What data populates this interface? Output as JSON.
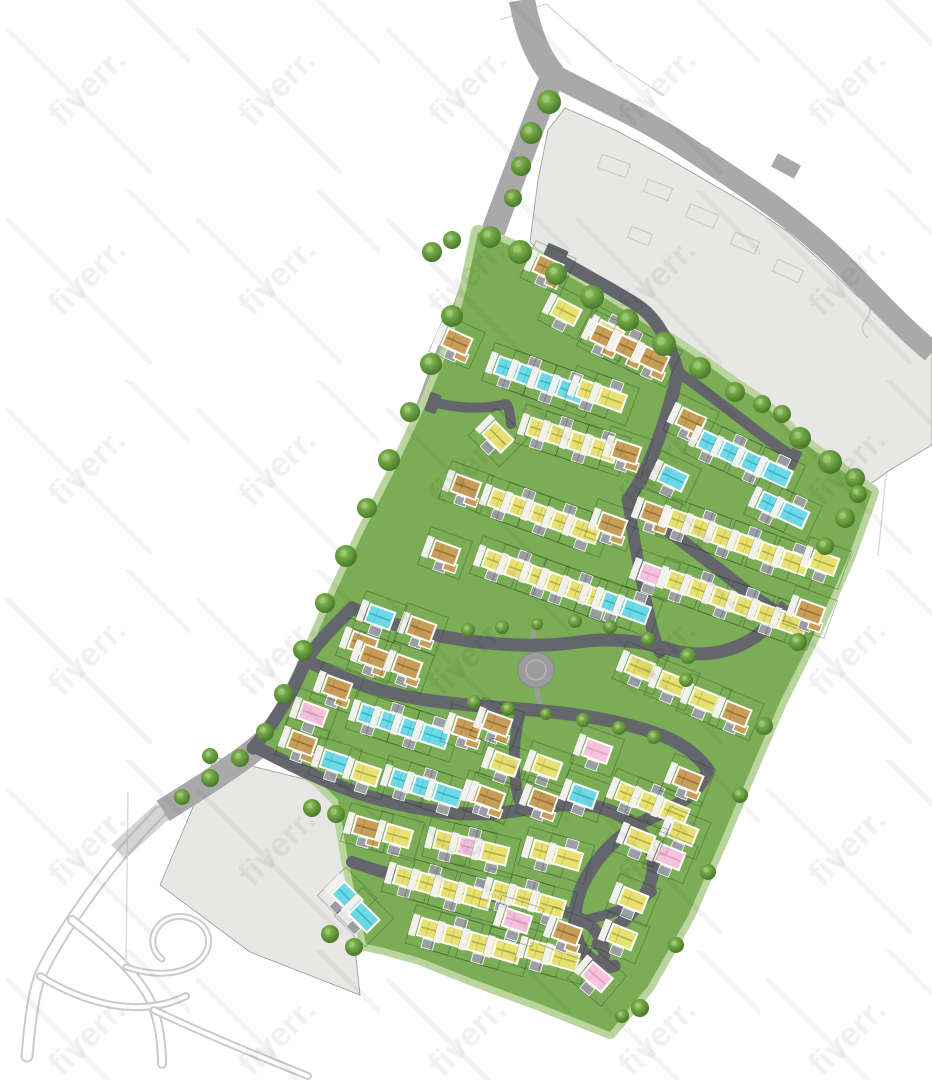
{
  "canvas": {
    "w": 932,
    "h": 1080
  },
  "watermark": {
    "text": "fiverr.",
    "tile": 190,
    "font_size": 34,
    "text_opacity": 0.055,
    "streak_opacity": 0.045
  },
  "colors": {
    "bg": "#ffffff",
    "road_outer": "#a9a9a9",
    "road_inner": "#64666c",
    "parcel": "#e7e7e5",
    "parcel_edge": "#9a9a98",
    "site_green": "#7aad55",
    "verge_green": "#b9d49c",
    "plaza": "#9c9c9e",
    "plot_line": "rgba(25,55,18,0.30)",
    "path_white": "#f2f1ed",
    "driveway": "#9b9ea2",
    "sketch": "#cbcbcb",
    "faint": "#d9d9d9",
    "roof": {
      "y": "#e6e170",
      "c": "#6ed9e6",
      "p": "#f6c3de",
      "t": "#c79d58"
    },
    "ridge": {
      "y": "#b6ad47",
      "c": "#38b6c9",
      "p": "#dd9ec4",
      "t": "#99743a"
    }
  },
  "site": {
    "points": "478,232 540,258 600,295 655,330 700,360 735,385 762,403 800,440 855,480 872,492 848,558 816,630 780,702 754,762 722,838 688,916 648,986 610,1032 540,1004 470,978 420,958 384,948 366,944 348,860 338,800 318,780 290,762 262,744 282,712 305,662 332,600 362,535 395,470 428,400 452,340 466,290"
  },
  "parcels": {
    "north": {
      "points": "565,108 615,130 662,155 705,180 748,205 788,232 822,262 856,295 890,322 932,352 932,445 890,470 862,490 830,465 790,435 755,405 725,382 690,358 650,328 600,292 548,260 530,242 538,180 548,130"
    },
    "sw": {
      "points": "215,757 320,783 338,802 350,900 360,995 250,952 160,885 196,800"
    }
  },
  "parcel_outlines": [
    [
      614,
      166,
      30,
      14,
      20
    ],
    [
      658,
      190,
      26,
      13,
      21
    ],
    [
      702,
      216,
      30,
      14,
      22
    ],
    [
      745,
      243,
      26,
      13,
      23
    ],
    [
      788,
      271,
      28,
      13,
      25
    ],
    [
      640,
      236,
      22,
      12,
      21
    ],
    [
      700,
      150,
      18,
      10,
      22
    ]
  ],
  "parcel_squiggles": [
    "M866,300 q8,10 0,20 q-8,10 2,18",
    "M688,142 q10,6 4,14"
  ],
  "boundary_roads": [
    {
      "d": "M522,0 C527,28 536,55 553,75",
      "w": 26,
      "op": 1
    },
    {
      "d": "M553,75 C600,100 640,116 688,148 C740,183 788,212 840,262 C872,295 905,330 932,352",
      "w": 22,
      "op": 1
    },
    {
      "d": "M553,75 C516,168 472,288 433,394 C396,496 346,610 301,694 C284,722 269,739 254,750 C226,772 196,790 163,811",
      "w": 24,
      "op": 1
    },
    {
      "d": "M163,811 L118,852",
      "w": 20,
      "op": 0.5
    }
  ],
  "road_stub": [
    786,
    166,
    26,
    15,
    28
  ],
  "road_notch": [
    173,
    777,
    26,
    16,
    -35
  ],
  "internal_roads": [
    {
      "d": "M556,258 C588,277 618,292 640,307 C658,320 670,344 678,372",
      "w": 13
    },
    {
      "d": "M678,372 C708,393 738,417 766,438 C778,447 786,452 792,457",
      "w": 11
    },
    {
      "d": "M678,372 C671,402 662,432 651,458 C644,474 636,489 628,500",
      "w": 13
    },
    {
      "d": "M628,500 C658,523 696,551 736,583 C752,596 766,605 774,611",
      "w": 13
    },
    {
      "d": "M437,403 C462,409 486,409 506,404 C508,404 510,412 511,424",
      "w": 10
    },
    {
      "d": "M306,660 C318,642 335,625 352,608 C390,625 432,636 470,641 C510,646 545,647 578,642 C612,637 645,642 672,650 C702,659 732,652 755,637 C766,629 772,621 776,613",
      "w": 13
    },
    {
      "d": "M253,748 C275,722 293,692 306,660 C340,678 378,692 420,699 C462,706 505,707 543,711 C583,715 620,721 655,733 C680,741 698,755 708,770",
      "w": 13
    },
    {
      "d": "M708,770 C700,792 678,806 655,816 C620,831 596,856 582,886 C572,912 572,936 584,952 C593,963 604,968 614,966",
      "w": 13
    },
    {
      "d": "M258,748 C300,770 338,788 378,799 C428,812 468,817 508,812 C543,807 573,801 598,807 C622,813 638,826 648,842 C657,860 654,880 643,898 C630,918 612,930 598,944",
      "w": 13
    },
    {
      "d": "M352,862 C392,876 432,886 476,893 C520,900 558,906 583,920 C598,929 605,943 604,957",
      "w": 12
    },
    {
      "d": "M583,920 C608,916 632,906 652,892",
      "w": 10
    },
    {
      "d": "M520,713 C513,742 512,772 519,800",
      "w": 11
    },
    {
      "d": "M628,500 C634,540 641,580 650,620 C653,633 656,644 660,652",
      "w": 12
    }
  ],
  "road_heads": [
    [
      556,
      253,
      22,
      13,
      24
    ],
    [
      793,
      459,
      20,
      12,
      115
    ],
    [
      779,
      613,
      22,
      13,
      130
    ],
    [
      433,
      403,
      12,
      20,
      20
    ]
  ],
  "park": {
    "plaza": {
      "cx": 536,
      "cy": 670,
      "r": 18
    },
    "stubs": [
      "M536,652 L533,630",
      "M537,688 L540,710"
    ]
  },
  "houses": {
    "defaults": {
      "w": 26,
      "h": 18
    },
    "rows": [
      {
        "x": 548,
        "y": 268,
        "a": 24,
        "g": 0,
        "c": "t"
      },
      {
        "x": 566,
        "y": 312,
        "a": 27,
        "g": 48,
        "c": "yy"
      },
      {
        "x": 605,
        "y": 337,
        "a": 25,
        "g": 27,
        "c": "ttt"
      },
      {
        "x": 457,
        "y": 342,
        "a": 24,
        "g": 0,
        "c": "t"
      },
      {
        "x": 509,
        "y": 369,
        "a": 20,
        "g": 22,
        "c": "cccc"
      },
      {
        "x": 591,
        "y": 392,
        "a": 20,
        "g": 22,
        "c": "yy"
      },
      {
        "x": 498,
        "y": 437,
        "a": 45,
        "g": 0,
        "c": "y"
      },
      {
        "x": 541,
        "y": 430,
        "a": 18,
        "g": 22,
        "c": "yyyy"
      },
      {
        "x": 626,
        "y": 452,
        "a": 18,
        "g": 0,
        "c": "t"
      },
      {
        "x": 691,
        "y": 421,
        "a": 25,
        "g": 0,
        "c": "t"
      },
      {
        "x": 712,
        "y": 444,
        "a": 25,
        "g": 24,
        "c": "cccc"
      },
      {
        "x": 673,
        "y": 478,
        "a": 25,
        "g": 0,
        "c": "c"
      },
      {
        "x": 772,
        "y": 505,
        "a": 25,
        "g": 24,
        "c": "cc"
      },
      {
        "x": 466,
        "y": 487,
        "a": 20,
        "g": 0,
        "c": "t"
      },
      {
        "x": 503,
        "y": 501,
        "a": 20,
        "g": 22,
        "c": "yyyyy"
      },
      {
        "x": 612,
        "y": 525,
        "a": 20,
        "g": 0,
        "c": "t"
      },
      {
        "x": 445,
        "y": 553,
        "a": 20,
        "g": 0,
        "c": "t"
      },
      {
        "x": 497,
        "y": 562,
        "a": 20,
        "g": 24,
        "c": "yyy"
      },
      {
        "x": 560,
        "y": 585,
        "a": 20,
        "g": 22,
        "c": "yyy"
      },
      {
        "x": 615,
        "y": 604,
        "a": 20,
        "g": 22,
        "c": "cc"
      },
      {
        "x": 655,
        "y": 514,
        "a": 20,
        "g": 0,
        "c": "t"
      },
      {
        "x": 682,
        "y": 522,
        "a": 20,
        "g": 24,
        "c": "yyyyyy"
      },
      {
        "x": 824,
        "y": 563,
        "a": 20,
        "g": 0,
        "c": "y"
      },
      {
        "x": 653,
        "y": 575,
        "a": 20,
        "g": 0,
        "c": "p"
      },
      {
        "x": 680,
        "y": 583,
        "a": 20,
        "g": 24,
        "c": "yyyyyy"
      },
      {
        "x": 810,
        "y": 612,
        "a": 20,
        "g": 0,
        "c": "t"
      },
      {
        "x": 640,
        "y": 668,
        "a": 22,
        "g": 0,
        "c": "y"
      },
      {
        "x": 672,
        "y": 684,
        "a": 22,
        "g": 0,
        "c": "y"
      },
      {
        "x": 704,
        "y": 700,
        "a": 22,
        "g": 0,
        "c": "y"
      },
      {
        "x": 736,
        "y": 714,
        "a": 22,
        "g": 0,
        "c": "t"
      },
      {
        "x": 337,
        "y": 688,
        "a": 20,
        "g": 0,
        "c": "t"
      },
      {
        "x": 313,
        "y": 714,
        "a": 20,
        "g": 0,
        "c": "p"
      },
      {
        "x": 302,
        "y": 743,
        "a": 20,
        "g": 0,
        "c": "t"
      },
      {
        "x": 372,
        "y": 716,
        "a": 18,
        "g": 22,
        "c": "cccc"
      },
      {
        "x": 467,
        "y": 729,
        "a": 18,
        "g": 0,
        "c": "t"
      },
      {
        "x": 335,
        "y": 762,
        "a": 18,
        "g": 0,
        "c": "c"
      },
      {
        "x": 366,
        "y": 774,
        "a": 18,
        "g": 0,
        "c": "y"
      },
      {
        "x": 404,
        "y": 781,
        "a": 18,
        "g": 23,
        "c": "ccc"
      },
      {
        "x": 484,
        "y": 796,
        "a": 18,
        "g": 0,
        "c": "t"
      },
      {
        "x": 497,
        "y": 724,
        "a": 20,
        "g": 0,
        "c": "t"
      },
      {
        "x": 505,
        "y": 764,
        "a": 20,
        "g": 0,
        "c": "y"
      },
      {
        "x": 547,
        "y": 767,
        "a": 20,
        "g": 0,
        "c": "y"
      },
      {
        "x": 597,
        "y": 751,
        "a": 20,
        "g": 0,
        "c": "p"
      },
      {
        "x": 490,
        "y": 798,
        "a": 20,
        "g": 0,
        "c": "t"
      },
      {
        "x": 543,
        "y": 801,
        "a": 20,
        "g": 0,
        "c": "t"
      },
      {
        "x": 583,
        "y": 796,
        "a": 20,
        "g": 0,
        "c": "c"
      },
      {
        "x": 363,
        "y": 644,
        "a": 20,
        "g": 0,
        "c": "t"
      },
      {
        "x": 374,
        "y": 657,
        "a": 20,
        "g": 0,
        "c": "t"
      },
      {
        "x": 407,
        "y": 667,
        "a": 20,
        "g": 0,
        "c": "t"
      },
      {
        "x": 421,
        "y": 629,
        "a": 20,
        "g": 0,
        "c": "t"
      },
      {
        "x": 380,
        "y": 617,
        "a": 20,
        "g": 0,
        "c": "c"
      },
      {
        "x": 367,
        "y": 828,
        "a": 16,
        "g": 0,
        "c": "t"
      },
      {
        "x": 398,
        "y": 836,
        "a": 16,
        "g": 0,
        "c": "y"
      },
      {
        "x": 448,
        "y": 842,
        "a": 14,
        "g": 24,
        "c": "ypy"
      },
      {
        "x": 545,
        "y": 852,
        "a": 16,
        "g": 24,
        "c": "yy"
      },
      {
        "x": 347,
        "y": 897,
        "a": 45,
        "g": 0,
        "c": "c"
      },
      {
        "x": 364,
        "y": 917,
        "a": 45,
        "g": 0,
        "c": "c"
      },
      {
        "x": 408,
        "y": 878,
        "a": 16,
        "g": 24,
        "c": "yyyy"
      },
      {
        "x": 505,
        "y": 893,
        "a": 16,
        "g": 24,
        "c": "yyy"
      },
      {
        "x": 432,
        "y": 930,
        "a": 16,
        "g": 26,
        "c": "yyyy"
      },
      {
        "x": 540,
        "y": 952,
        "a": 16,
        "g": 26,
        "c": "yy"
      },
      {
        "x": 517,
        "y": 921,
        "a": 18,
        "g": 0,
        "c": "p"
      },
      {
        "x": 567,
        "y": 933,
        "a": 20,
        "g": 0,
        "c": "t"
      },
      {
        "x": 597,
        "y": 977,
        "a": 40,
        "g": 0,
        "c": "p"
      },
      {
        "x": 630,
        "y": 795,
        "a": 22,
        "g": 24,
        "c": "yyy"
      },
      {
        "x": 688,
        "y": 780,
        "a": 22,
        "g": 0,
        "c": "t"
      },
      {
        "x": 683,
        "y": 833,
        "a": 22,
        "g": 0,
        "c": "y"
      },
      {
        "x": 670,
        "y": 857,
        "a": 22,
        "g": 0,
        "c": "p"
      },
      {
        "x": 640,
        "y": 840,
        "a": 22,
        "g": 0,
        "c": "y"
      },
      {
        "x": 633,
        "y": 900,
        "a": 22,
        "g": 0,
        "c": "y"
      },
      {
        "x": 622,
        "y": 937,
        "a": 22,
        "g": 0,
        "c": "y"
      }
    ]
  },
  "trees": [
    [
      490,
      237,
      11
    ],
    [
      520,
      252,
      12
    ],
    [
      556,
      274,
      11
    ],
    [
      592,
      297,
      12
    ],
    [
      628,
      320,
      11
    ],
    [
      664,
      344,
      12
    ],
    [
      700,
      368,
      11
    ],
    [
      735,
      392,
      10
    ],
    [
      762,
      404,
      9
    ],
    [
      782,
      414,
      9
    ],
    [
      800,
      438,
      11
    ],
    [
      830,
      462,
      12
    ],
    [
      855,
      478,
      10
    ],
    [
      858,
      494,
      9
    ],
    [
      845,
      518,
      10
    ],
    [
      825,
      546,
      9
    ],
    [
      798,
      642,
      9
    ],
    [
      764,
      726,
      9
    ],
    [
      740,
      795,
      8
    ],
    [
      708,
      872,
      8
    ],
    [
      676,
      945,
      8
    ],
    [
      640,
      1008,
      9
    ],
    [
      622,
      1016,
      7
    ],
    [
      452,
      316,
      11
    ],
    [
      431,
      364,
      11
    ],
    [
      410,
      412,
      10
    ],
    [
      389,
      460,
      11
    ],
    [
      367,
      508,
      10
    ],
    [
      346,
      556,
      11
    ],
    [
      325,
      603,
      10
    ],
    [
      303,
      650,
      10
    ],
    [
      284,
      694,
      10
    ],
    [
      265,
      732,
      9
    ],
    [
      240,
      758,
      9
    ],
    [
      210,
      778,
      9
    ],
    [
      182,
      797,
      8
    ],
    [
      549,
      102,
      12
    ],
    [
      531,
      133,
      11
    ],
    [
      521,
      166,
      10
    ],
    [
      513,
      198,
      9
    ],
    [
      432,
      252,
      10
    ],
    [
      452,
      240,
      9
    ],
    [
      468,
      630,
      7
    ],
    [
      502,
      627,
      7
    ],
    [
      537,
      624,
      6
    ],
    [
      575,
      621,
      7
    ],
    [
      610,
      627,
      7
    ],
    [
      648,
      639,
      7
    ],
    [
      474,
      702,
      7
    ],
    [
      508,
      709,
      7
    ],
    [
      546,
      714,
      6
    ],
    [
      583,
      720,
      7
    ],
    [
      619,
      728,
      7
    ],
    [
      654,
      737,
      7
    ],
    [
      688,
      656,
      8
    ],
    [
      686,
      680,
      7
    ],
    [
      312,
      808,
      9
    ],
    [
      336,
      814,
      9
    ],
    [
      330,
      934,
      9
    ],
    [
      354,
      947,
      9
    ],
    [
      210,
      756,
      8
    ]
  ],
  "sketch_roads": [
    {
      "d": "M160,812 C122,850 92,890 72,920 C56,944 46,962 40,976 C34,992 30,1020 27,1056",
      "w": 13
    },
    {
      "d": "M72,920 C92,936 112,952 126,967 C140,982 150,996 154,1010 C160,1028 162,1048 162,1064",
      "w": 10
    },
    {
      "d": "M40,976 C62,990 86,1000 112,1005 C142,1010 166,1006 186,996",
      "w": 8
    },
    {
      "d": "M154,1010 C200,1032 258,1056 308,1076",
      "w": 8
    },
    {
      "d": "M126,967 C152,976 180,976 198,962 C212,950 212,932 198,922 C184,913 166,915 157,928 C150,938 152,952 162,959",
      "w": 7
    }
  ],
  "faint_lines": [
    "M546,4 L612,62",
    "M500,20 L546,4",
    "M616,64 L664,96",
    "M900,332 L878,556",
    "M128,792 L126,966"
  ]
}
